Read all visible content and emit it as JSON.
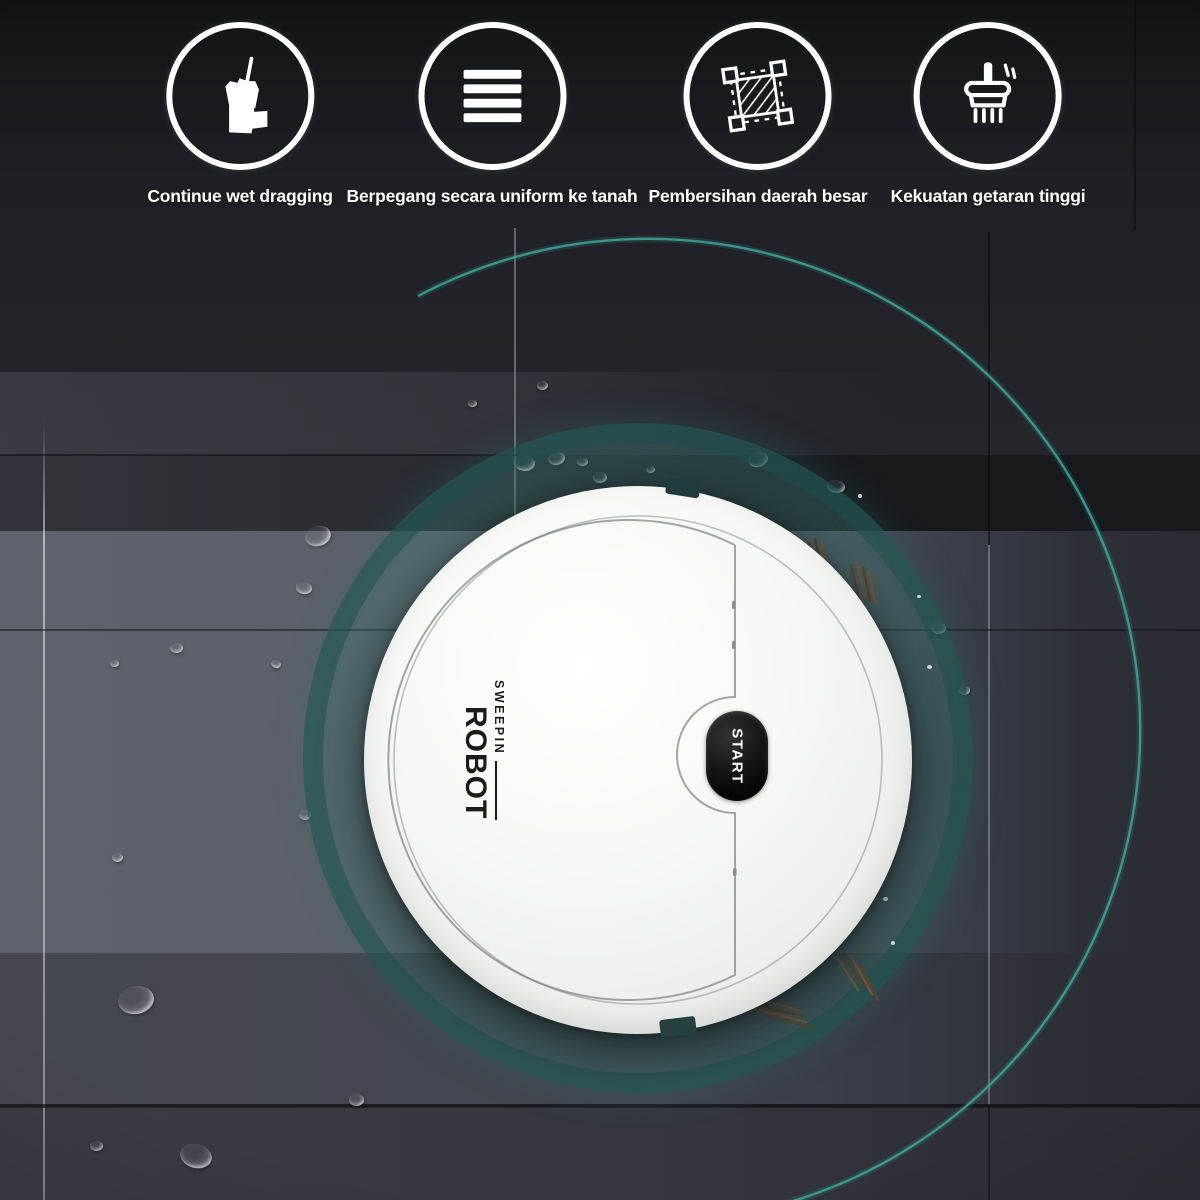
{
  "features": [
    {
      "icon": "mop-bucket-icon",
      "label": "Continue wet dragging"
    },
    {
      "icon": "ground-grip-bars-icon",
      "label": "Berpegang secara uniform ke tanah"
    },
    {
      "icon": "large-area-clean-icon",
      "label": "Pembersihan daerah besar"
    },
    {
      "icon": "vibration-brush-icon",
      "label": "Kekuatan getaran tinggi"
    }
  ],
  "robot": {
    "brand_line1": "SWEEPIN",
    "brand_line2": "ROBOT",
    "start_button": "START"
  },
  "palette": {
    "teal_ring": "#3fa69b",
    "teal_disc": "#2f7a73",
    "floor_dark": "#1b1d22",
    "robot_white": "#f4f5f3",
    "button_black": "#0b0b0b",
    "bristle_brown": "#74553a"
  }
}
